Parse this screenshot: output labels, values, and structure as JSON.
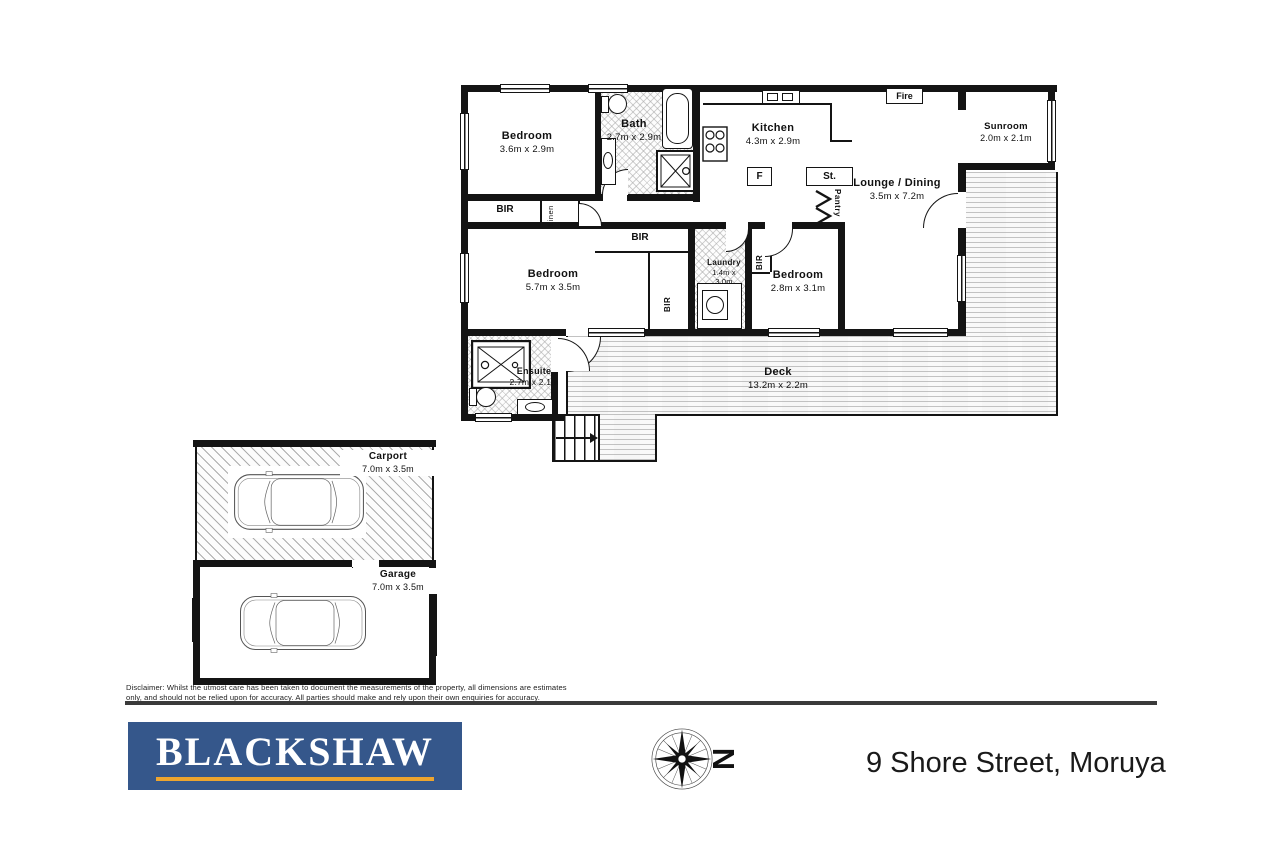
{
  "plan": {
    "rooms": [
      {
        "id": "bedroom-1",
        "name": "Bedroom",
        "dims": "3.6m x 2.9m"
      },
      {
        "id": "bath",
        "name": "Bath",
        "dims": "2.7m x 2.9m"
      },
      {
        "id": "kitchen",
        "name": "Kitchen",
        "dims": "4.3m x 2.9m"
      },
      {
        "id": "sunroom",
        "name": "Sunroom",
        "dims": "2.0m x 2.1m"
      },
      {
        "id": "lounge-dining",
        "name": "Lounge / Dining",
        "dims": "3.5m x 7.2m"
      },
      {
        "id": "bedroom-2",
        "name": "Bedroom",
        "dims": "5.7m x 3.5m"
      },
      {
        "id": "laundry",
        "name": "Laundry",
        "dims": "1.4m x 3.0m"
      },
      {
        "id": "bedroom-3",
        "name": "Bedroom",
        "dims": "2.8m x 3.1m"
      },
      {
        "id": "deck",
        "name": "Deck",
        "dims": "13.2m x 2.2m"
      },
      {
        "id": "ensuite",
        "name": "Ensuite",
        "dims": "2.7m x 2.1m"
      },
      {
        "id": "carport",
        "name": "Carport",
        "dims": "7.0m x 3.5m"
      },
      {
        "id": "garage",
        "name": "Garage",
        "dims": "7.0m x 3.5m"
      }
    ],
    "labels": {
      "bir": "BIR",
      "linen": "Linen",
      "pantry": "Pantry",
      "st": "St.",
      "fridge": "F",
      "fire": "Fire"
    }
  },
  "compass": {
    "north": "N"
  },
  "brand": {
    "name": "BLACKSHAW"
  },
  "address": "9 Shore Street, Moruya",
  "footer": {
    "disclaimer_line1": "Disclaimer: Whilst the utmost care has been taken to document the measurements of the property, all dimensions are estimates",
    "disclaimer_line2": "only, and should not be relied upon for accuracy.  All parties should make and rely upon their own enquiries for accuracy."
  },
  "colors": {
    "brand_blue": "#35578b",
    "brand_gold": "#eda52f",
    "wall": "#141414"
  }
}
